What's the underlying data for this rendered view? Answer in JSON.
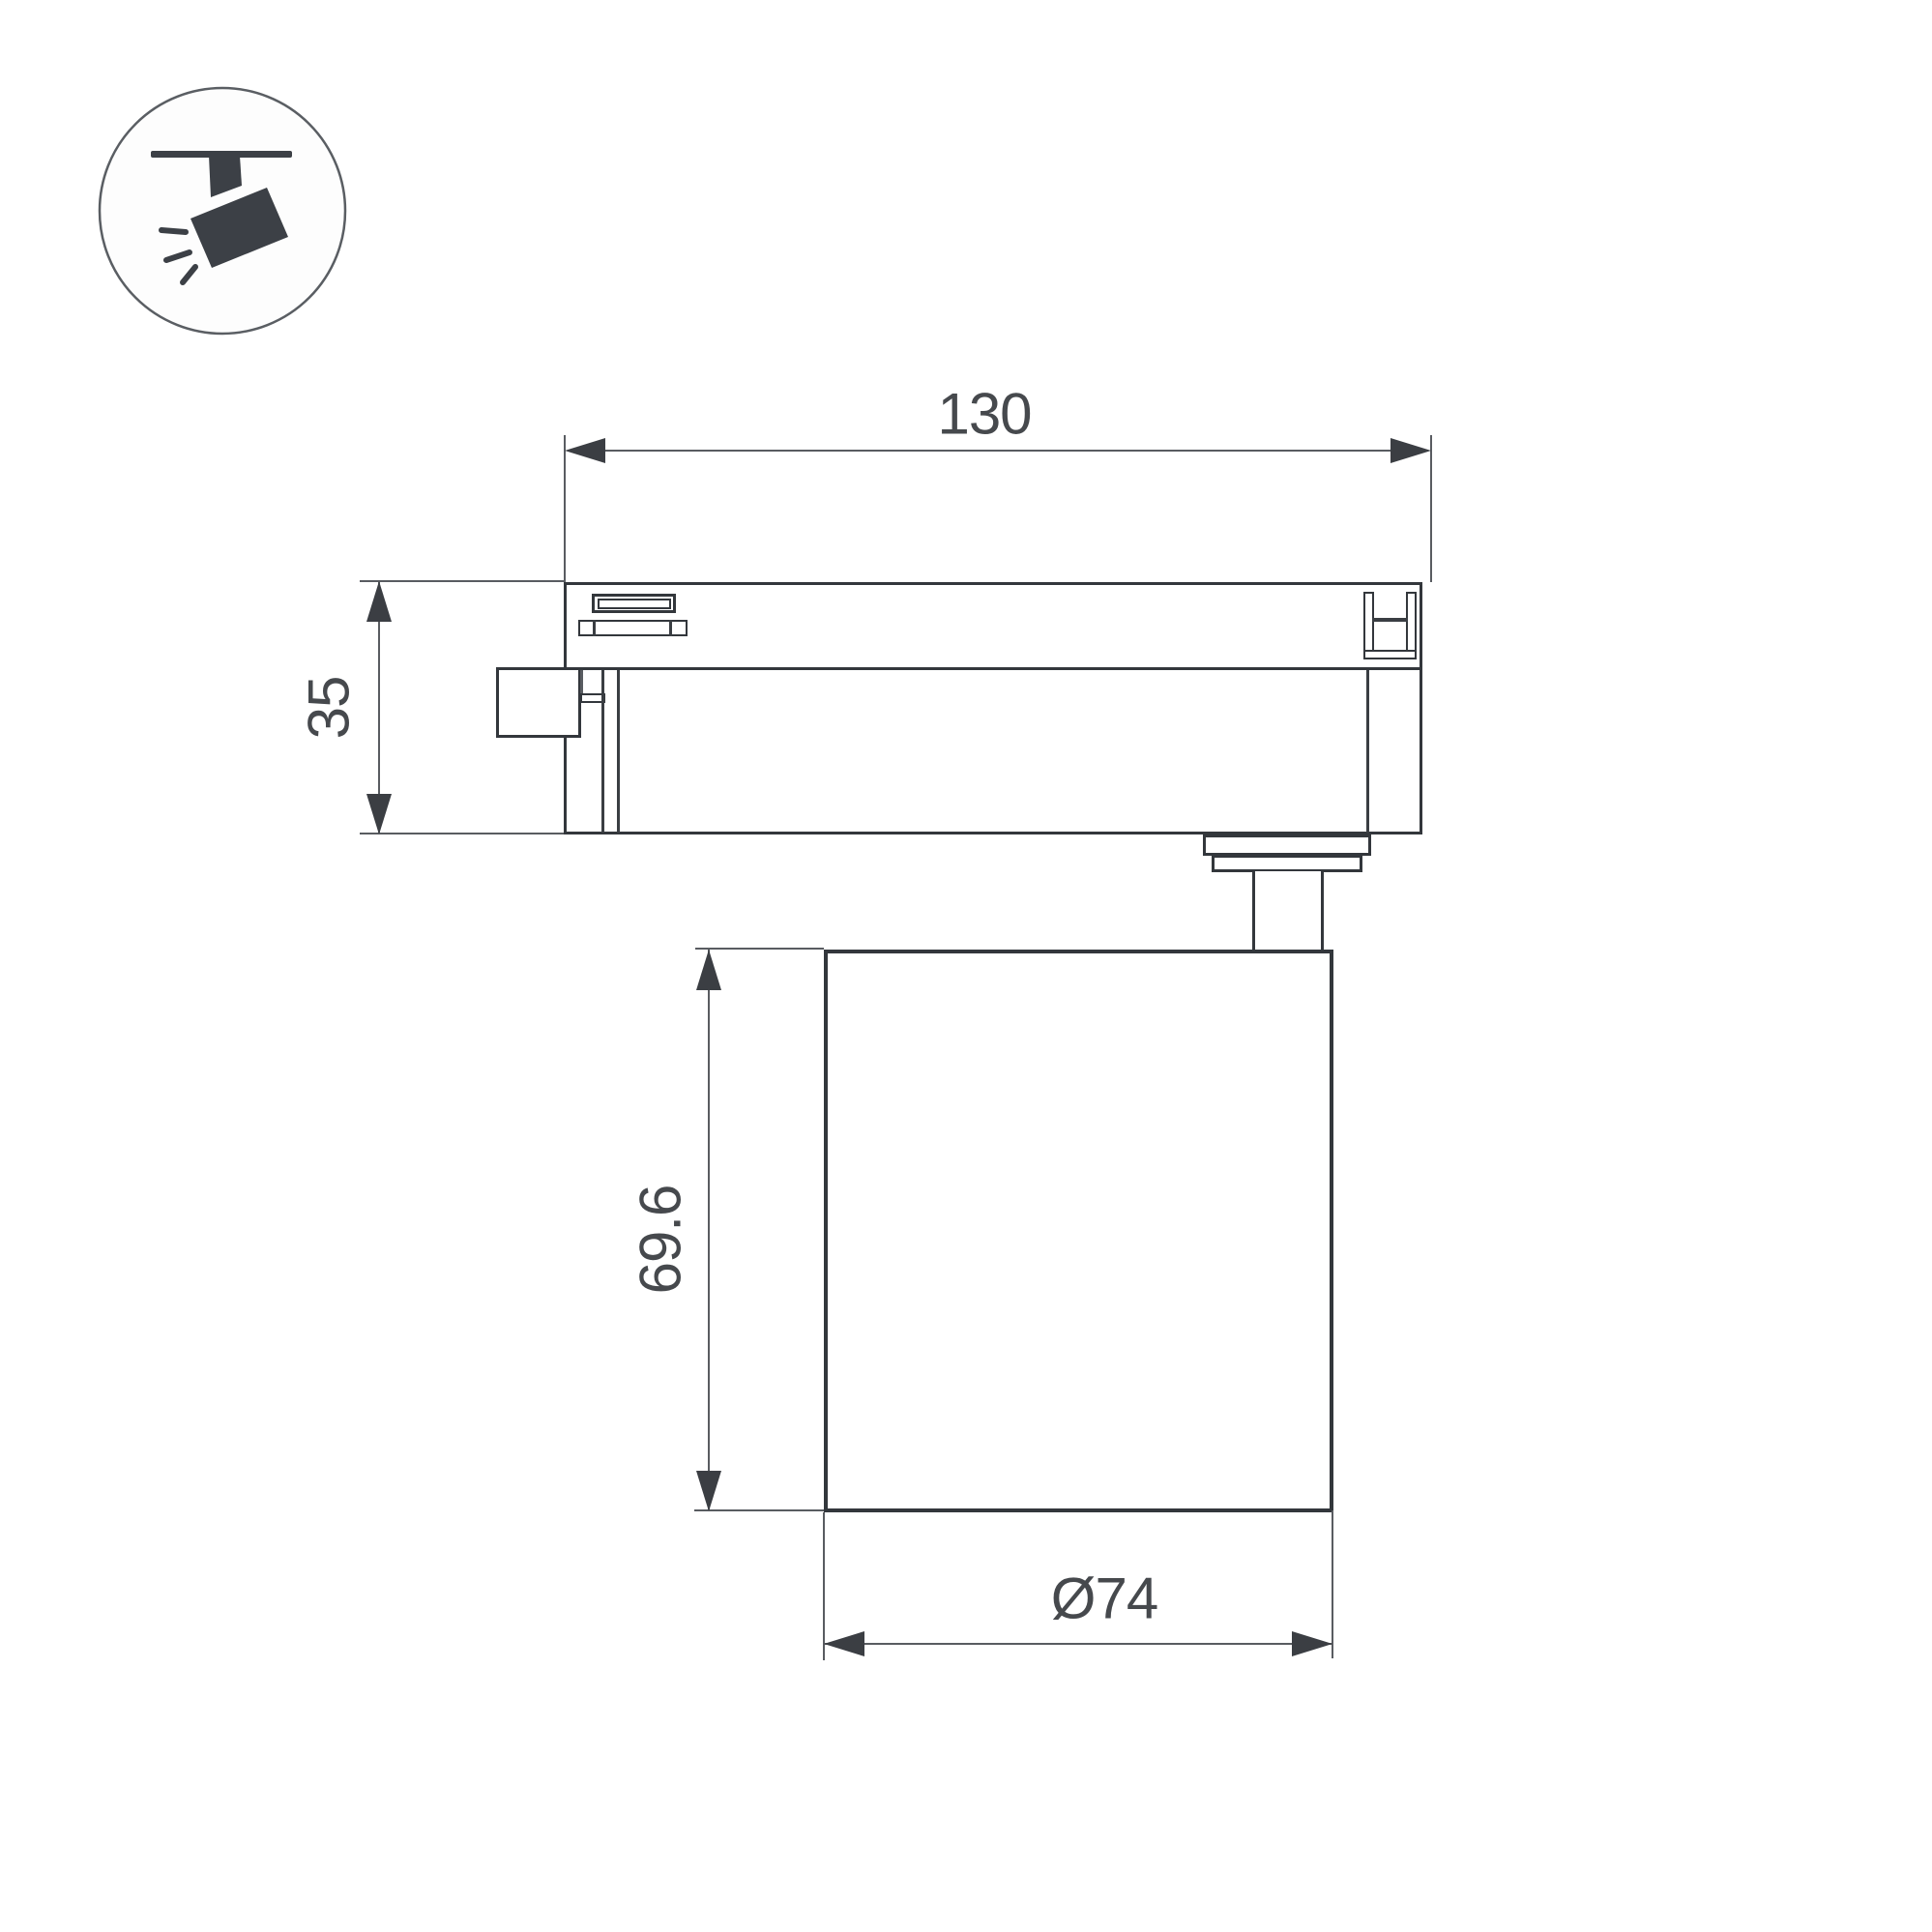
{
  "drawing": {
    "type": "technical-dimension-drawing",
    "subject": "ceiling track spotlight, side elevation view",
    "icon": {
      "name": "track-spotlight-icon",
      "depicts": "circle badge with ceiling track bar, mounting stem and tilted spotlight head emitting three light rays"
    },
    "dimensions": {
      "track_adapter_length": {
        "label": "130",
        "orientation": "horizontal"
      },
      "track_adapter_height": {
        "label": "35",
        "orientation": "vertical"
      },
      "lamp_head_height": {
        "label": "69.6",
        "orientation": "vertical"
      },
      "lamp_head_diameter": {
        "label": "Ø74",
        "orientation": "horizontal"
      }
    },
    "colors": {
      "background": "#ffffff",
      "outline": "#33373c",
      "thin_line": "#595c61",
      "text": "#46494d",
      "icon_fill": "#3c4046",
      "icon_circle_stroke": "#5a5e63"
    }
  }
}
